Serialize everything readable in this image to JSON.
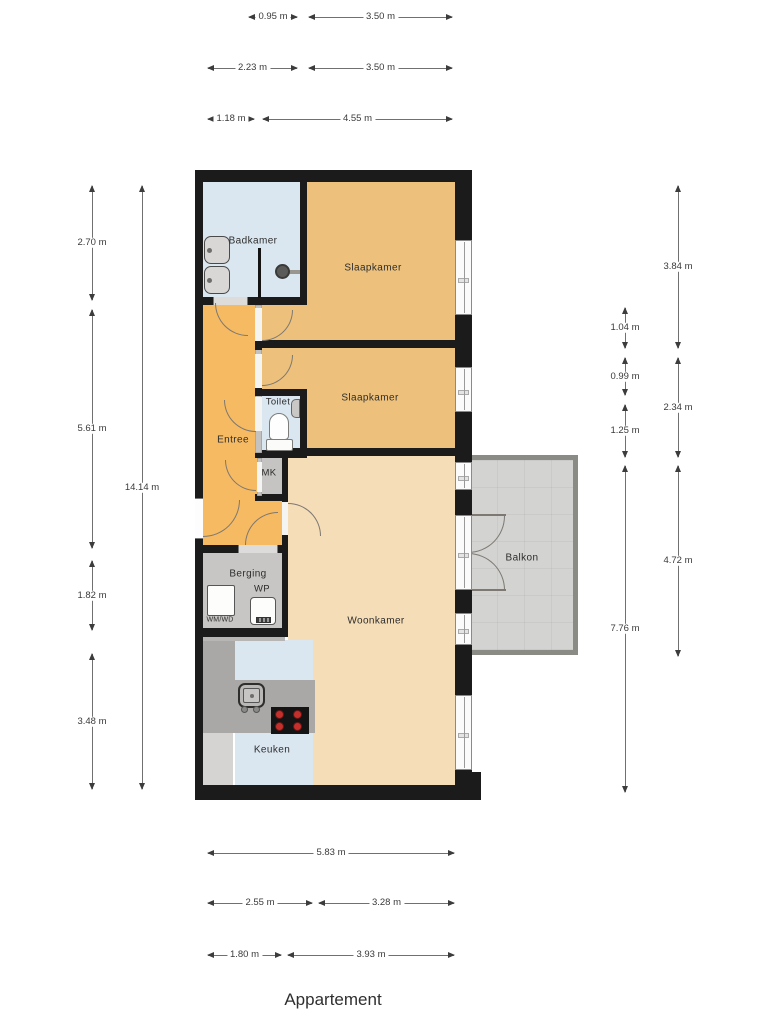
{
  "title": "Appartement",
  "rooms": {
    "badkamer": "Badkamer",
    "slaapkamer_1": "Slaapkamer",
    "slaapkamer_2": "Slaapkamer",
    "toilet": "Toilet",
    "entree": "Entree",
    "mk": "MK",
    "berging": "Berging",
    "wp": "WP",
    "wm_wd": "WM/WD",
    "woonkamer": "Woonkamer",
    "keuken": "Keuken",
    "balkon": "Balkon"
  },
  "dimensions": {
    "top": [
      [
        "0.95 m",
        "3.50 m"
      ],
      [
        "2.23 m",
        "3.50 m"
      ],
      [
        "1.18 m",
        "4.55 m"
      ]
    ],
    "bottom": [
      [
        "5.83 m"
      ],
      [
        "2.55 m",
        "3.28 m"
      ],
      [
        "1.80 m",
        "3.93 m"
      ]
    ],
    "left": [
      "2.70 m",
      "5.61 m",
      "1.82 m",
      "3.48 m"
    ],
    "left_total": "14.14 m",
    "right": [
      "1.04 m",
      "0.99 m",
      "1.25 m",
      "7.76 m"
    ],
    "right_outer": [
      "3.84 m",
      "2.34 m",
      "4.72 m"
    ]
  },
  "colors": {
    "wall": "#1b1b1b",
    "bedroom": "#edc17c",
    "entry": "#f6ba62",
    "living": "#f5ddb7",
    "wet_room": "#dbe7f0",
    "storage": "#c8c6c4",
    "counter": "#a9a8a6",
    "balcony": "#d3d3d1",
    "balcony_border": "#8b8b86",
    "cooktop_burner": "#c4302b"
  }
}
